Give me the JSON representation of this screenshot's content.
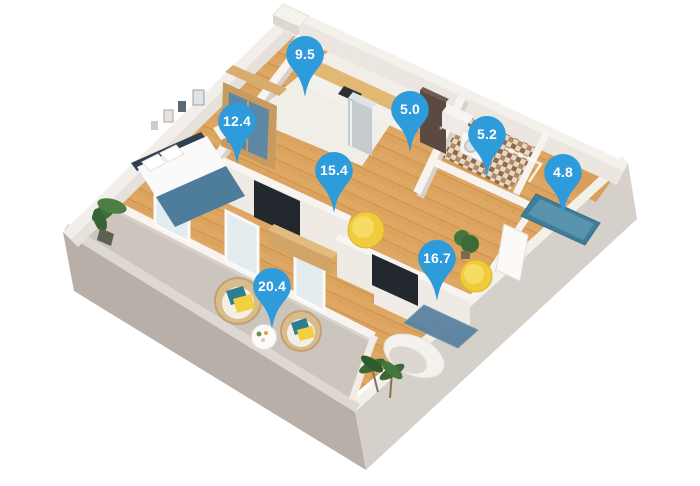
{
  "pins": [
    {
      "room": "kitchen",
      "value": "9.5"
    },
    {
      "room": "bedroom",
      "value": "12.4"
    },
    {
      "room": "hallway",
      "value": "5.0"
    },
    {
      "room": "living-room",
      "value": "15.4"
    },
    {
      "room": "bathroom",
      "value": "5.2"
    },
    {
      "room": "bathroom-2",
      "value": "4.8"
    },
    {
      "room": "bedroom-2",
      "value": "16.7"
    },
    {
      "room": "balcony",
      "value": "20.4"
    }
  ],
  "palette": {
    "background": "#ffffff",
    "pin": "#2e9bdb",
    "pin_text": "#ffffff",
    "wall_top": "#f7f4ef",
    "wall_shadow": "#d8d1c9",
    "exterior_se_face": "#d6d0ca",
    "exterior_sw_face": "#b7afa8",
    "wood_floor": "#dca35f",
    "marble_floor": "#f1ede7",
    "balcony_floor": "#cbc5be",
    "bathroom_tile": "#b08966",
    "accent_yellow": "#f0cb3c",
    "accent_teal": "#2e7e93",
    "accent_blue": "#4e7d9b"
  }
}
